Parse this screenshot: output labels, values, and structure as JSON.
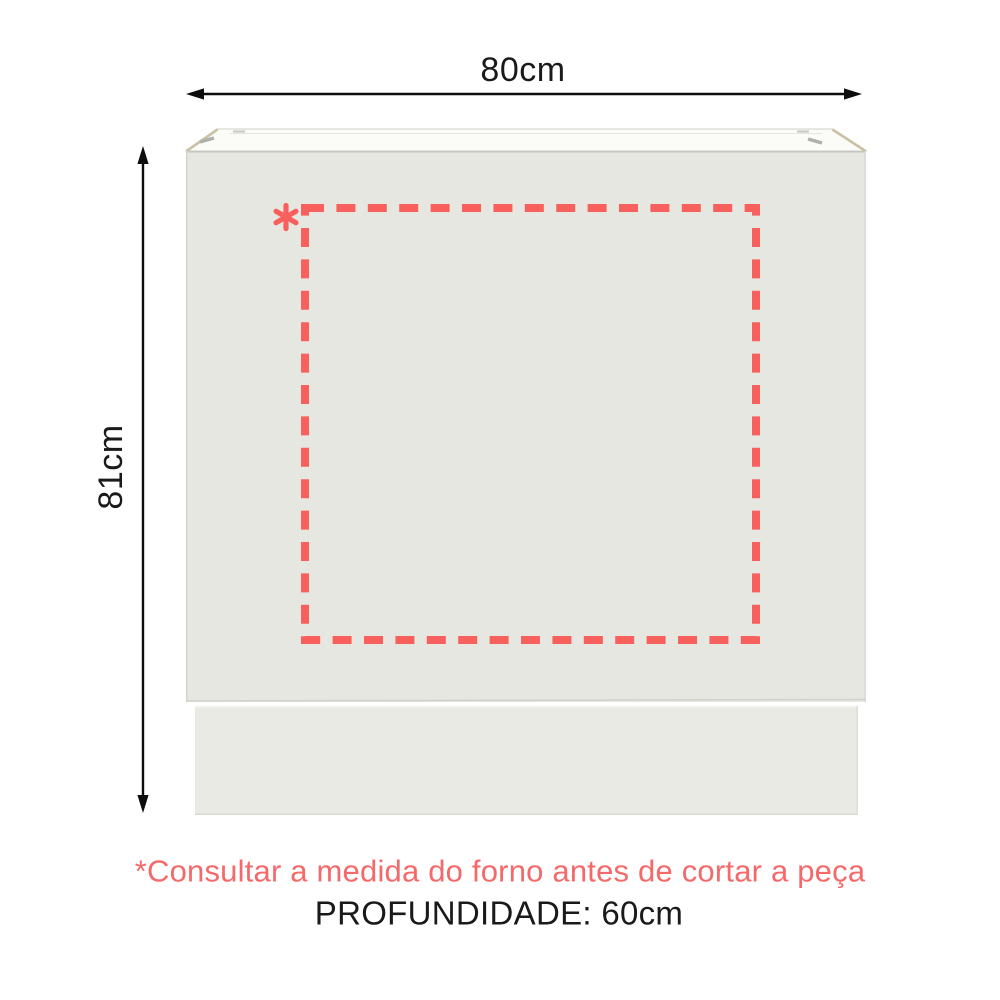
{
  "diagram": {
    "type": "product-dimensions",
    "subject": "kitchen-base-cabinet",
    "width_label": "80cm",
    "height_label": "81cm",
    "depth_label": "PROFUNDIDADE: 60cm",
    "footnote": "*Consultar a medida do forno antes de cortar a peça",
    "oven_cutout_marker": "*"
  },
  "colors": {
    "background": "#ffffff",
    "accent_text": "#f4696a",
    "dash": "#f8605e",
    "dimension_text": "#1a1a1a",
    "arrow": "#0d0d0d",
    "cabinet_face": "#e7e7e1",
    "cabinet_top": "#fbfbf7",
    "cabinet_edge_tan": "#c9c2a4",
    "plinth": "#eaeae4"
  }
}
